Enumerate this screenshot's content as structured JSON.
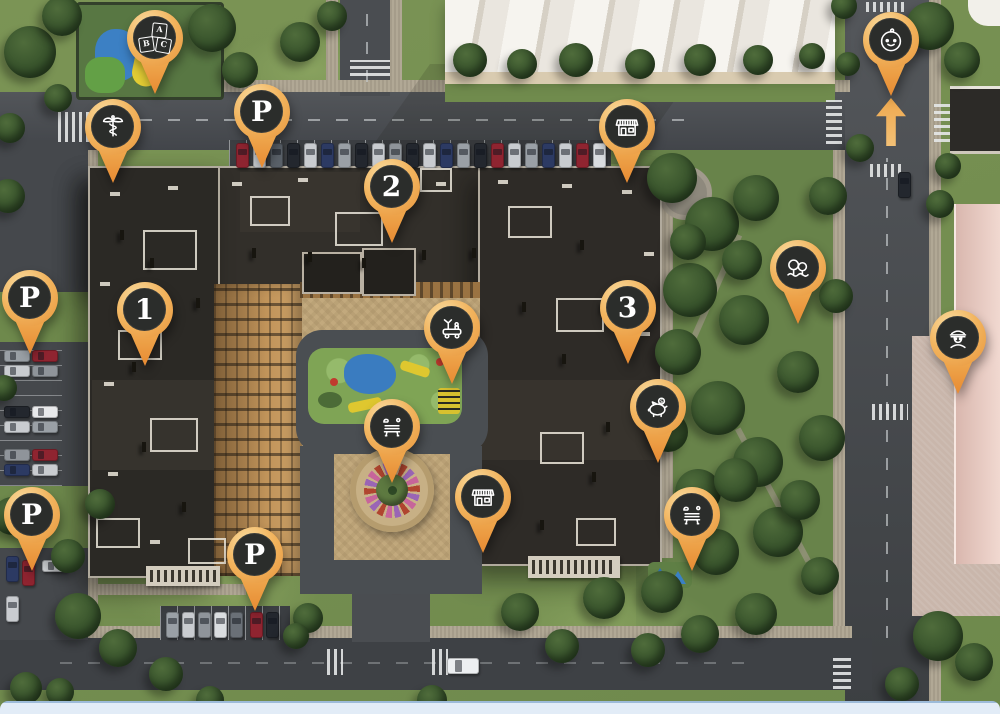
{
  "map": {
    "description": "Aerial 3D masterplan of a residential complex with amenity map pins",
    "pins": [
      {
        "id": "kindergarten",
        "icon": "abc-blocks-icon",
        "label": "",
        "x": 155,
        "y": 38
      },
      {
        "id": "medical",
        "icon": "caduceus-icon",
        "label": "",
        "x": 113,
        "y": 127
      },
      {
        "id": "parking-north",
        "icon": "letter",
        "label": "P",
        "x": 262,
        "y": 112
      },
      {
        "id": "building-2",
        "icon": "number",
        "label": "2",
        "x": 392,
        "y": 187
      },
      {
        "id": "store-north",
        "icon": "storefront-icon",
        "label": "",
        "x": 627,
        "y": 127
      },
      {
        "id": "nursery",
        "icon": "baby-icon",
        "label": "",
        "x": 891,
        "y": 40
      },
      {
        "id": "parking-west",
        "icon": "letter",
        "label": "P",
        "x": 30,
        "y": 298
      },
      {
        "id": "building-1",
        "icon": "number",
        "label": "1",
        "x": 145,
        "y": 310
      },
      {
        "id": "building-3",
        "icon": "number",
        "label": "3",
        "x": 628,
        "y": 308
      },
      {
        "id": "playground",
        "icon": "toy-truck-icon",
        "label": "",
        "x": 452,
        "y": 328
      },
      {
        "id": "park",
        "icon": "trees-icon",
        "label": "",
        "x": 798,
        "y": 268
      },
      {
        "id": "police",
        "icon": "police-officer-icon",
        "label": "",
        "x": 958,
        "y": 338
      },
      {
        "id": "bank",
        "icon": "piggy-bank-icon",
        "label": "",
        "x": 658,
        "y": 407
      },
      {
        "id": "bench-courtyard",
        "icon": "bench-icon",
        "label": "",
        "x": 392,
        "y": 427
      },
      {
        "id": "store-south",
        "icon": "storefront-icon",
        "label": "",
        "x": 483,
        "y": 497
      },
      {
        "id": "bench-park",
        "icon": "bench-icon",
        "label": "",
        "x": 692,
        "y": 515
      },
      {
        "id": "parking-southwest",
        "icon": "letter",
        "label": "P",
        "x": 32,
        "y": 515
      },
      {
        "id": "parking-south",
        "icon": "letter",
        "label": "P",
        "x": 255,
        "y": 555
      }
    ],
    "entrance_arrow": {
      "direction": "up",
      "x": 891,
      "y": 122
    },
    "colors": {
      "pin_orange": "#F0A855",
      "pin_orange_deep": "#E78A32",
      "pin_disc": "#2B2D2B",
      "pin_glyph": "#FFFFFF",
      "grass": "#75904F",
      "asphalt": "#46494D",
      "roof_dark": "#2D2A26",
      "courtyard_paving": "#C2A97D",
      "bottom_strip": "#E2ECF7"
    }
  }
}
